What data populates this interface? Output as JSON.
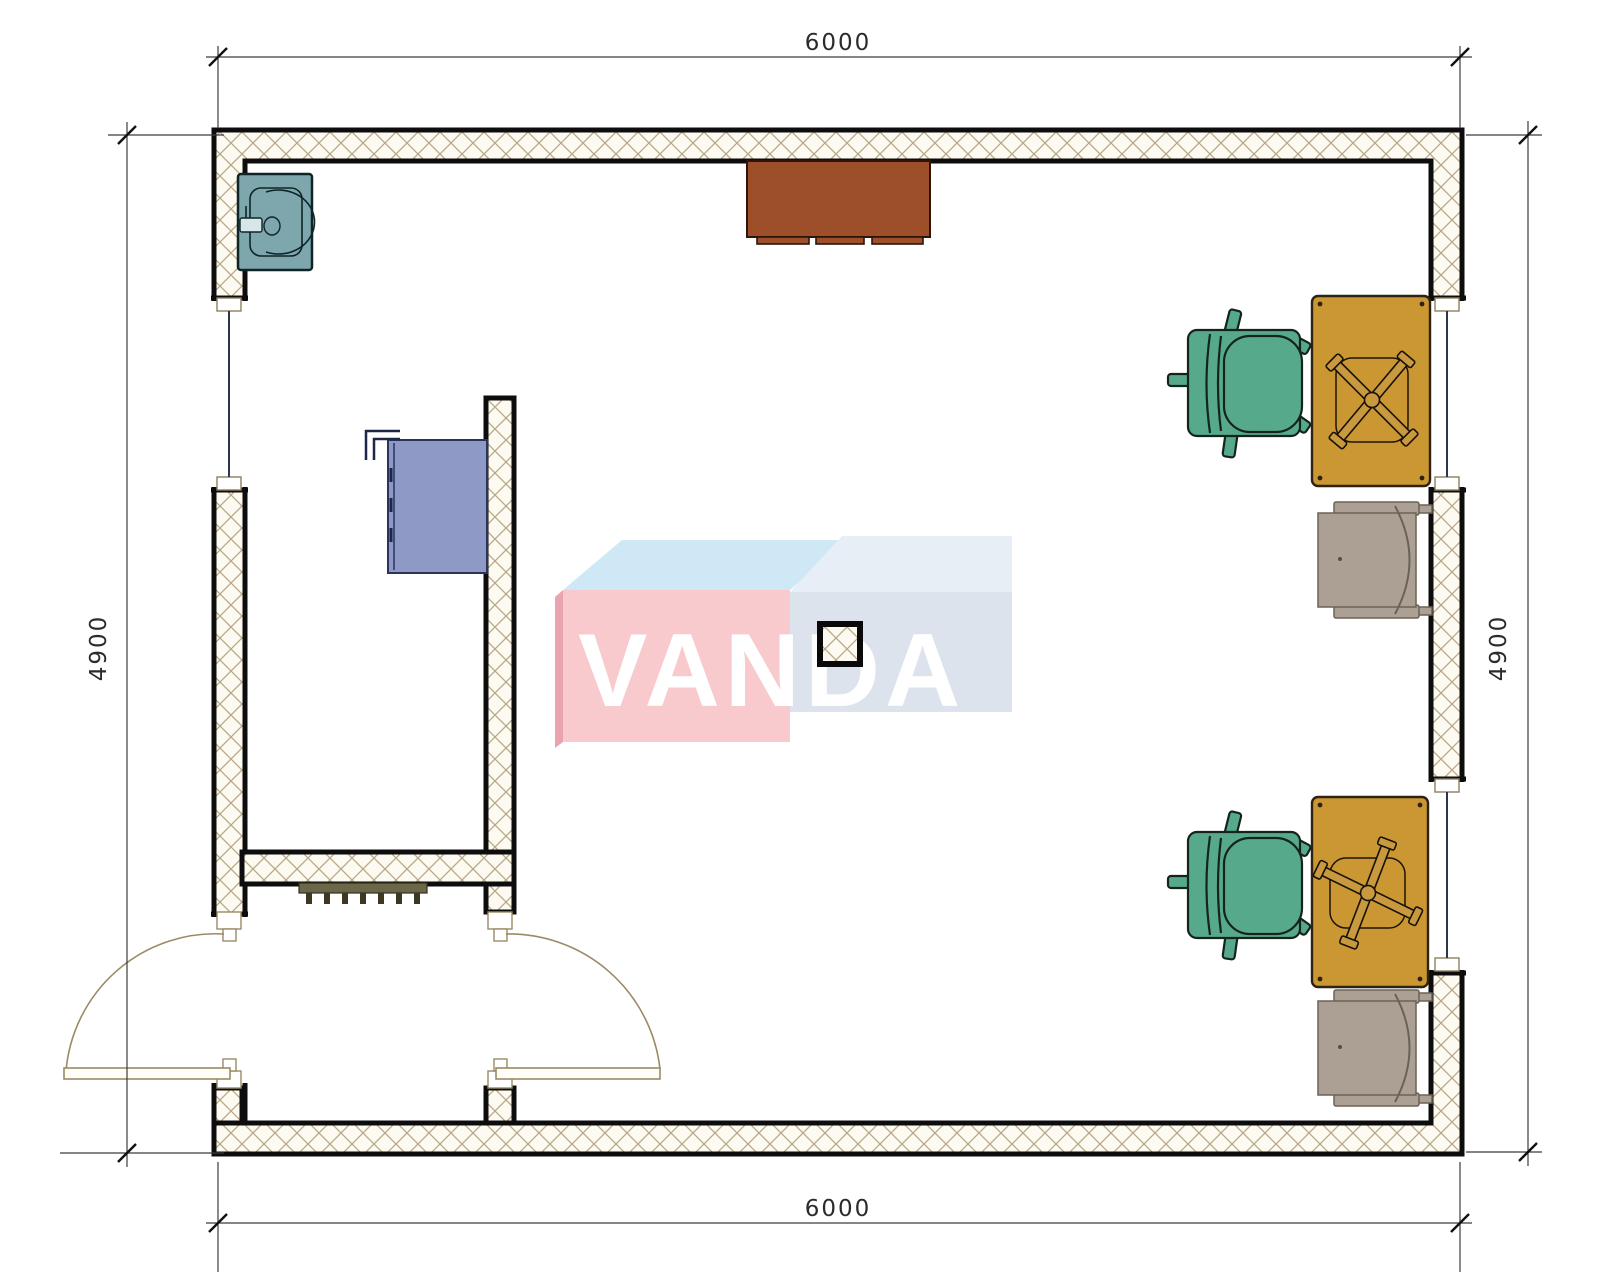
{
  "drawing": {
    "type": "floor-plan",
    "dimensions": {
      "top": "6000",
      "bottom": "6000",
      "left": "4900",
      "right": "4900"
    },
    "watermark": {
      "text": "VANDA"
    },
    "colors": {
      "sink": "#7EA7AD",
      "cabinet_brown": "#9D4F29",
      "cabinet_blue": "#8E9AC5",
      "desk": "#CB9733",
      "chair_green": "#57A98C",
      "chair_gray": "#ACA094",
      "radiator": "#6B6748",
      "door": "#9B8A65",
      "wall_hatch_line": "#B9A887",
      "watermark_pink": "#F8CACD",
      "watermark_blue_face": "#DCE3ED",
      "watermark_top": "#CFE8F6"
    },
    "furniture": [
      "sink",
      "countertop-cabinet",
      "wall-cabinet",
      "radiator",
      "column",
      "desk-1",
      "desk-2",
      "office-chair-1",
      "office-chair-2",
      "side-chair-1",
      "side-chair-2",
      "double-entry-door",
      "window-left",
      "window-right-upper",
      "window-right-lower"
    ]
  }
}
